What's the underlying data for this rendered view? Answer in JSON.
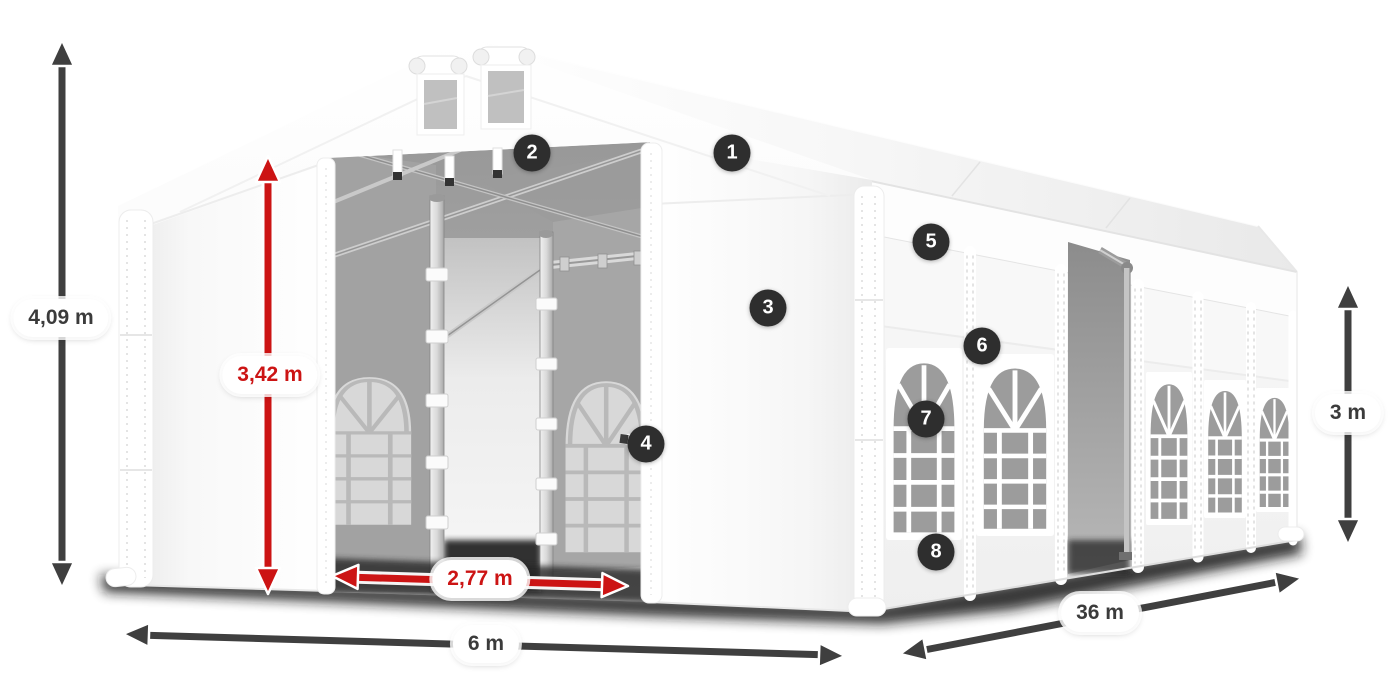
{
  "measurements": {
    "total_height": {
      "value": "4,09 m",
      "style": "dark"
    },
    "inner_height": {
      "value": "3,42 m",
      "style": "red"
    },
    "entrance_width": {
      "value": "2,77 m",
      "style": "red"
    },
    "span_width": {
      "value": "6 m",
      "style": "dark"
    },
    "length": {
      "value": "36 m",
      "style": "dark"
    },
    "side_height": {
      "value": "3 m",
      "style": "dark"
    }
  },
  "hotspots": [
    "1",
    "2",
    "3",
    "4",
    "5",
    "6",
    "7",
    "8"
  ],
  "colors": {
    "background": "#ffffff",
    "dimension_arrow_dark": "#3f3f3f",
    "dimension_arrow_red": "#cc1414",
    "hotspot_badge_background": "#2e2e2e",
    "hotspot_badge_text": "#ffffff"
  }
}
